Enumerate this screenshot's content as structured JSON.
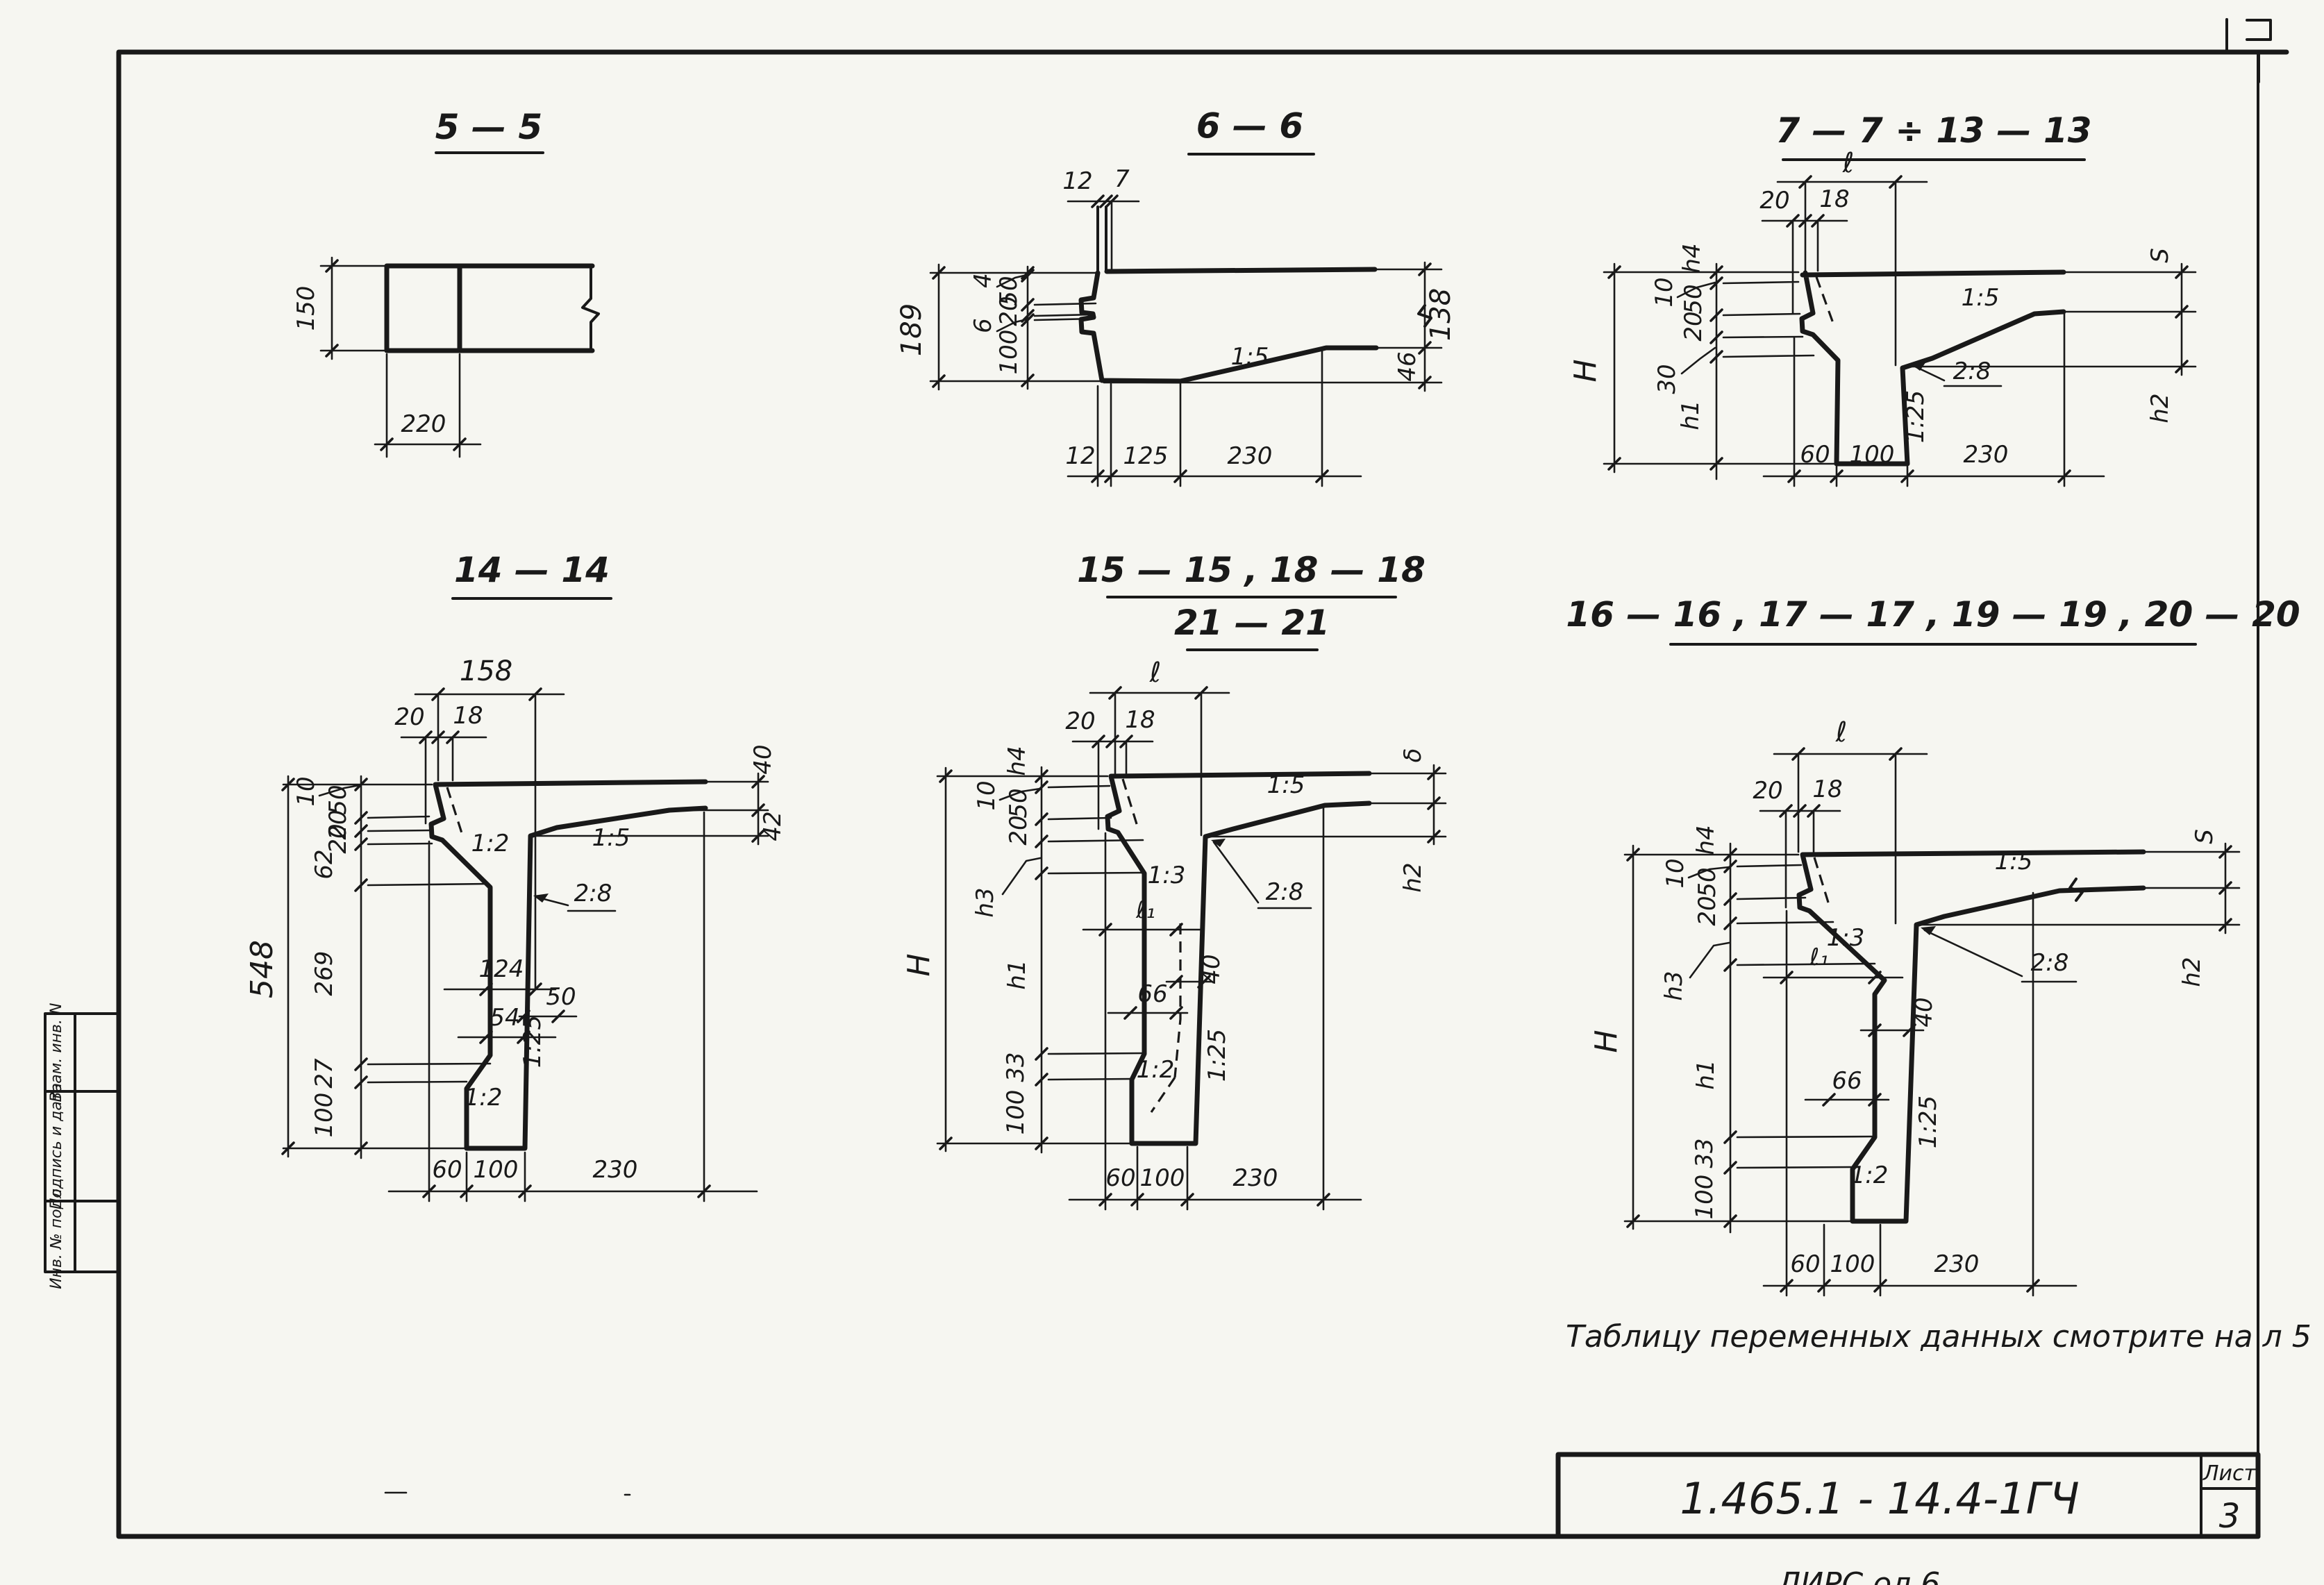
{
  "sections": {
    "s5": {
      "title": "5 — 5",
      "height": "150",
      "width": "220"
    },
    "s6": {
      "title": "6 — 6",
      "top": [
        "12",
        "7"
      ],
      "overall_left": "189",
      "chain": [
        "4",
        "50",
        "20",
        "6",
        "100"
      ],
      "right": [
        "138",
        "46"
      ],
      "bottom": [
        "12",
        "125",
        "230"
      ],
      "slope_15": "1:5"
    },
    "s7": {
      "title": "7 — 7 ÷ 13 — 13",
      "len": "ℓ",
      "top": [
        "20",
        "18"
      ],
      "h4": "h4",
      "lead10": "10",
      "c50": "50",
      "c20": "20",
      "lead30": "30",
      "H": "H",
      "h1": "h1",
      "S": "S",
      "h2": "h2",
      "bottom": [
        "60",
        "100",
        "230"
      ],
      "slope_15": "1:5",
      "slope_28": "2:8",
      "slope_125": "1:25"
    },
    "s14": {
      "title": "14 — 14",
      "w158": "158",
      "top": [
        "20",
        "18"
      ],
      "overall_left": "548",
      "lead10": "10",
      "chain": [
        "50",
        "20",
        "20",
        "62",
        "269",
        "27",
        "100"
      ],
      "d124": "124",
      "d54": "54",
      "d50": "50",
      "right": [
        "40",
        "42"
      ],
      "bottom": [
        "60",
        "100",
        "230"
      ],
      "slope_15": "1:5",
      "slope_12a": "1:2",
      "slope_28": "2:8",
      "slope_125": "1:25",
      "slope_12b": "1:2"
    },
    "s15": {
      "title1": "15 — 15 ,  18 — 18",
      "title2": "21 — 21",
      "len": "ℓ",
      "len1": "ℓ₁",
      "top": [
        "20",
        "18"
      ],
      "h4": "h4",
      "lead10": "10",
      "c50": "50",
      "c20": "20",
      "h3": "h3",
      "h1": "h1",
      "d33": "33",
      "d100": "100",
      "H": "H",
      "S": "δ",
      "h2": "h2",
      "d40": "40",
      "d66": "66",
      "bottom": [
        "60",
        "100",
        "230"
      ],
      "slope_15": "1:5",
      "slope_13": "1:3",
      "slope_28": "2:8",
      "slope_125": "1:25",
      "slope_12": "1:2"
    },
    "s16": {
      "title": "16 — 16 , 17 — 17 ,  19 — 19 ,  20 — 20",
      "len": "ℓ",
      "len1": "ℓ₁",
      "top": [
        "20",
        "18"
      ],
      "h4": "h4",
      "lead10": "10",
      "c50": "50",
      "c20": "20",
      "h3": "h3",
      "h1": "h1",
      "d33": "33",
      "d100": "100",
      "H": "H",
      "S": "S",
      "h2": "h2",
      "d40": "40",
      "d66": "66",
      "bottom": [
        "60",
        "100",
        "230"
      ],
      "slope_15": "1:5",
      "slope_13": "1:3",
      "slope_28": "2:8",
      "slope_125": "1:25",
      "slope_12": "1:2"
    }
  },
  "note": "Таблицу переменных данных смотрите на л 5",
  "titleblock": {
    "doc": "1.465.1 - 14.4-1ГЧ",
    "sheet_label": "Лист",
    "sheet_no": "3"
  },
  "stamp": {
    "box1": "Взам. инв. N",
    "box2": "Подпись и дата",
    "box3": "Инв. № подл."
  },
  "cutoff": "ЛИРС  ол          6"
}
